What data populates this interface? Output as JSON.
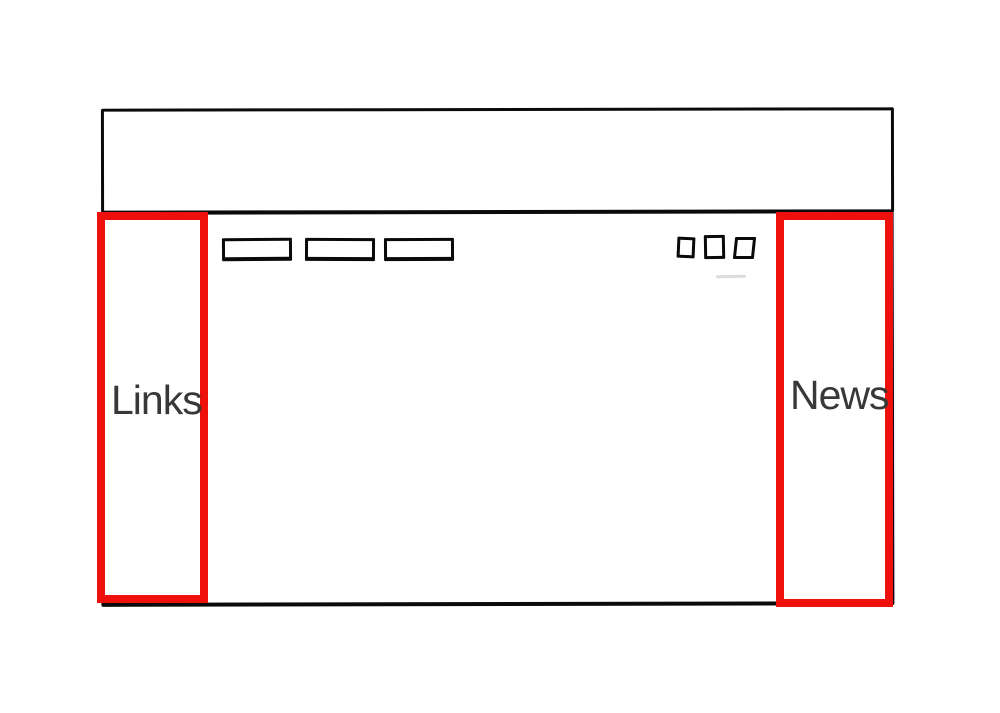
{
  "palette": {
    "ink": "#0a0a0a",
    "highlight_red": "#ee100b",
    "label_gray": "#383838"
  },
  "wireframe": {
    "left_overlay": {
      "label": "Links"
    },
    "right_overlay": {
      "label": "News"
    }
  }
}
